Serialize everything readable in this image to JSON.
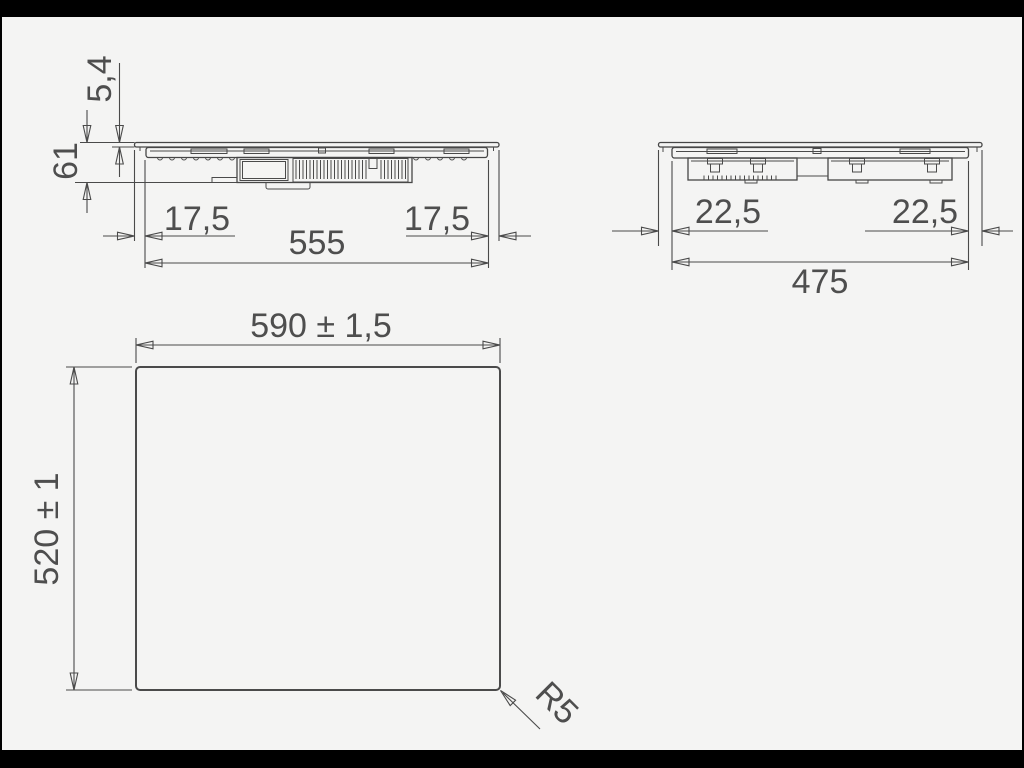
{
  "drawing": {
    "type": "installation-dimension-drawing",
    "views": {
      "front": {
        "name": "front elevation",
        "dims": {
          "glass_thickness": "5,4",
          "total_height": "61",
          "offset_left": "17,5",
          "body_width": "555",
          "offset_right": "17,5"
        }
      },
      "side": {
        "name": "side elevation",
        "dims": {
          "offset_left": "22,5",
          "offset_right": "22,5",
          "body_depth": "475"
        }
      },
      "top": {
        "name": "glass panel outline",
        "dims": {
          "width": "590 ± 1,5",
          "depth": "520 ± 1",
          "corner_radius": "R5"
        }
      }
    },
    "colors": {
      "background": "#f4f4f3",
      "frame": "#000000",
      "line": "#4a4a4a",
      "text": "#4e4e4e"
    }
  }
}
